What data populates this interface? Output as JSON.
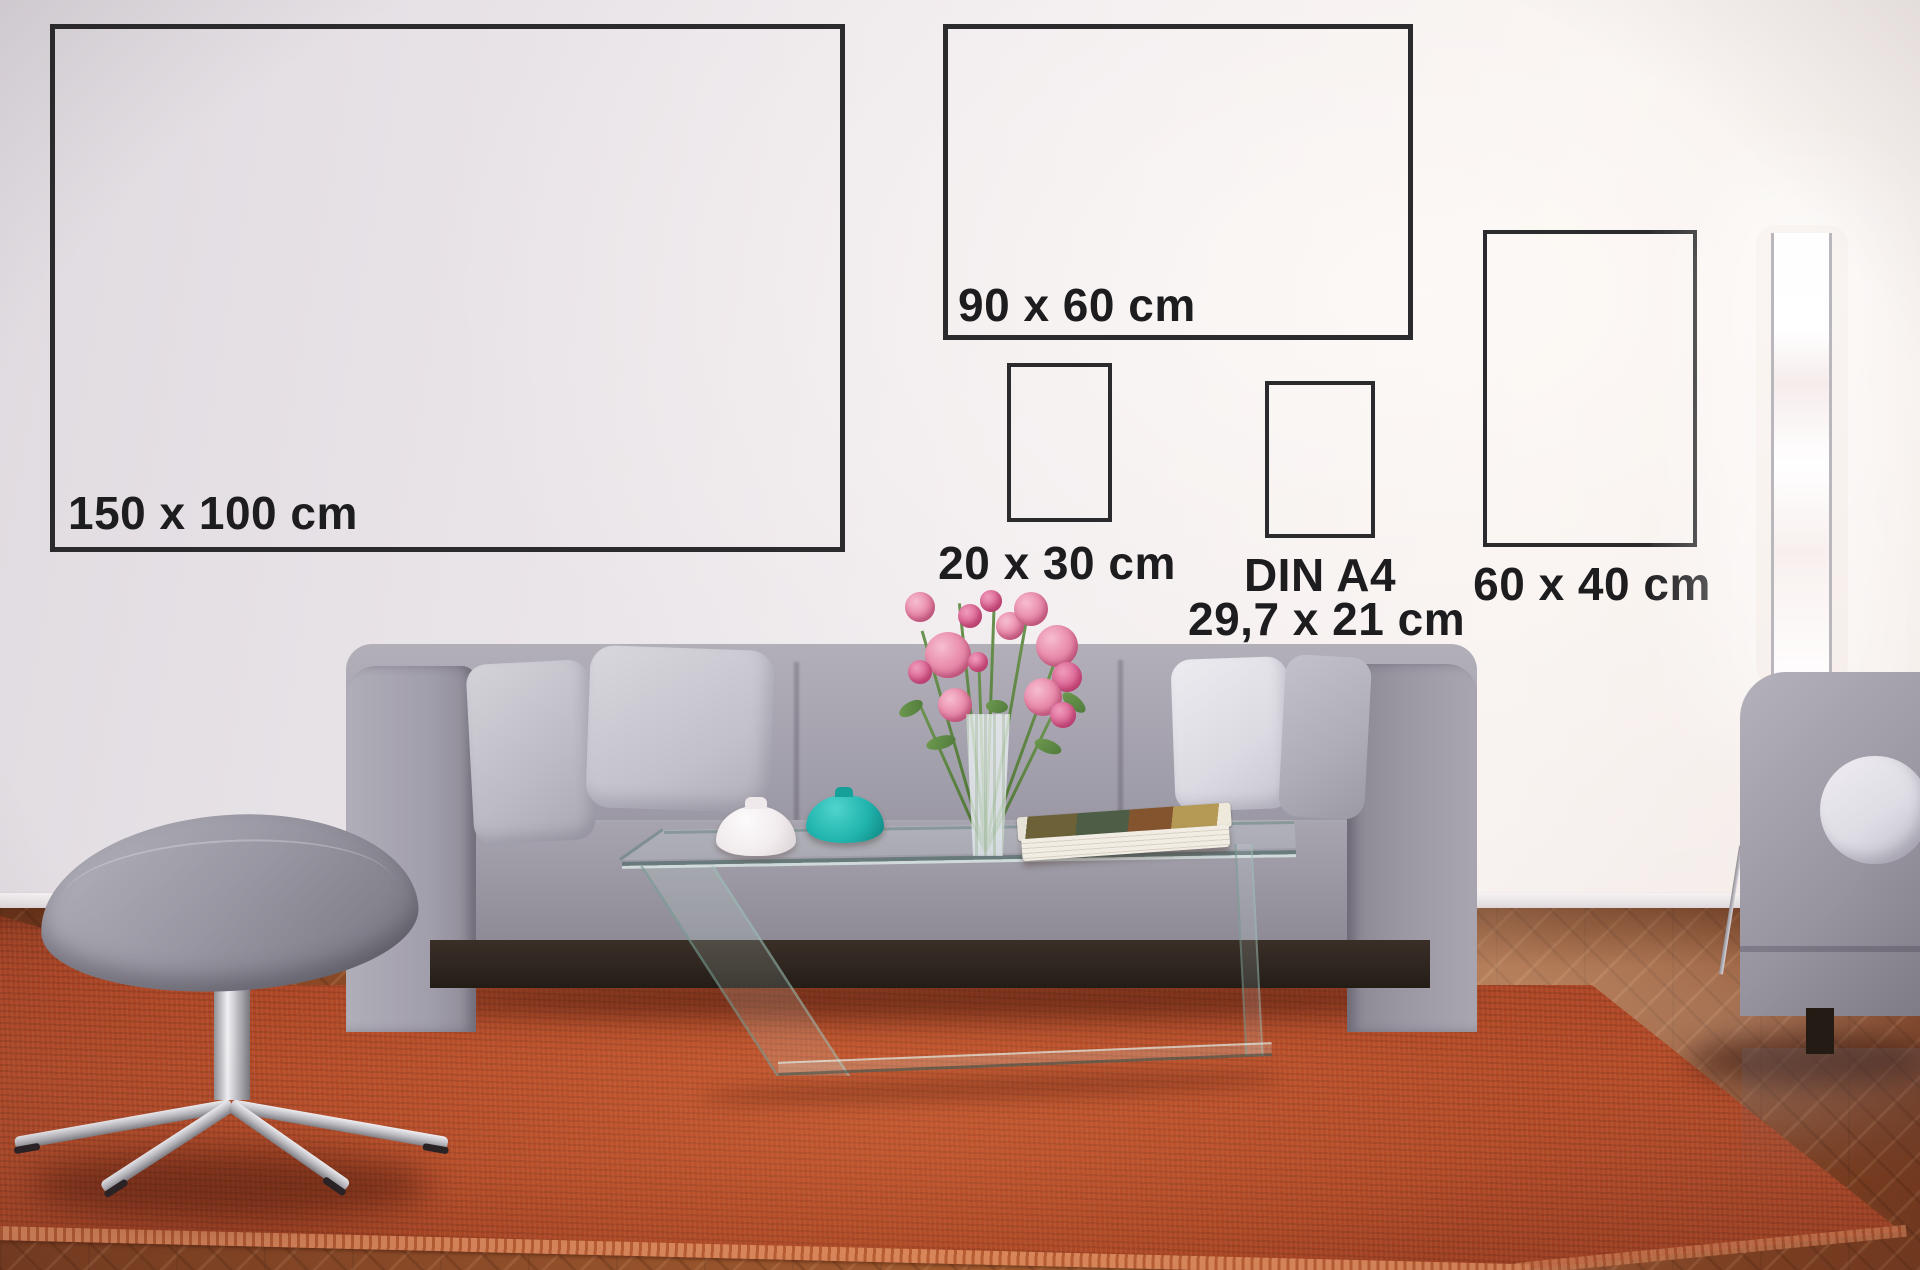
{
  "frames": [
    {
      "id": "150x100",
      "label": "150 x 100 cm"
    },
    {
      "id": "90x60",
      "label": "90 x 60 cm"
    },
    {
      "id": "20x30",
      "label": "20 x 30 cm"
    },
    {
      "id": "din-a4",
      "label": "DIN A4",
      "sublabel": "29,7 x 21 cm"
    },
    {
      "id": "60x40",
      "label": "60 x 40 cm"
    }
  ],
  "colors": {
    "wall": "#ebe6ea",
    "frame_border": "#2b2a2c",
    "label_text": "#1d1c1e",
    "sofa": "#a09da8",
    "pillow_light": "#cac9d1",
    "pillow_white": "#e7e6eb",
    "rug": "#b04726",
    "rug_fringe": "#d8855a",
    "floor": "#8f4c28",
    "plinth": "#2f2620",
    "ottoman": "#908e99",
    "chrome": "#d9d9de",
    "teal_vase": "#21b4ae",
    "white_vase": "#f3eff1",
    "flower_pink": "#e07ca0",
    "stem_green": "#5d8043",
    "book_pages": "#f1ece4",
    "lamp_glow": "#ffffff"
  }
}
